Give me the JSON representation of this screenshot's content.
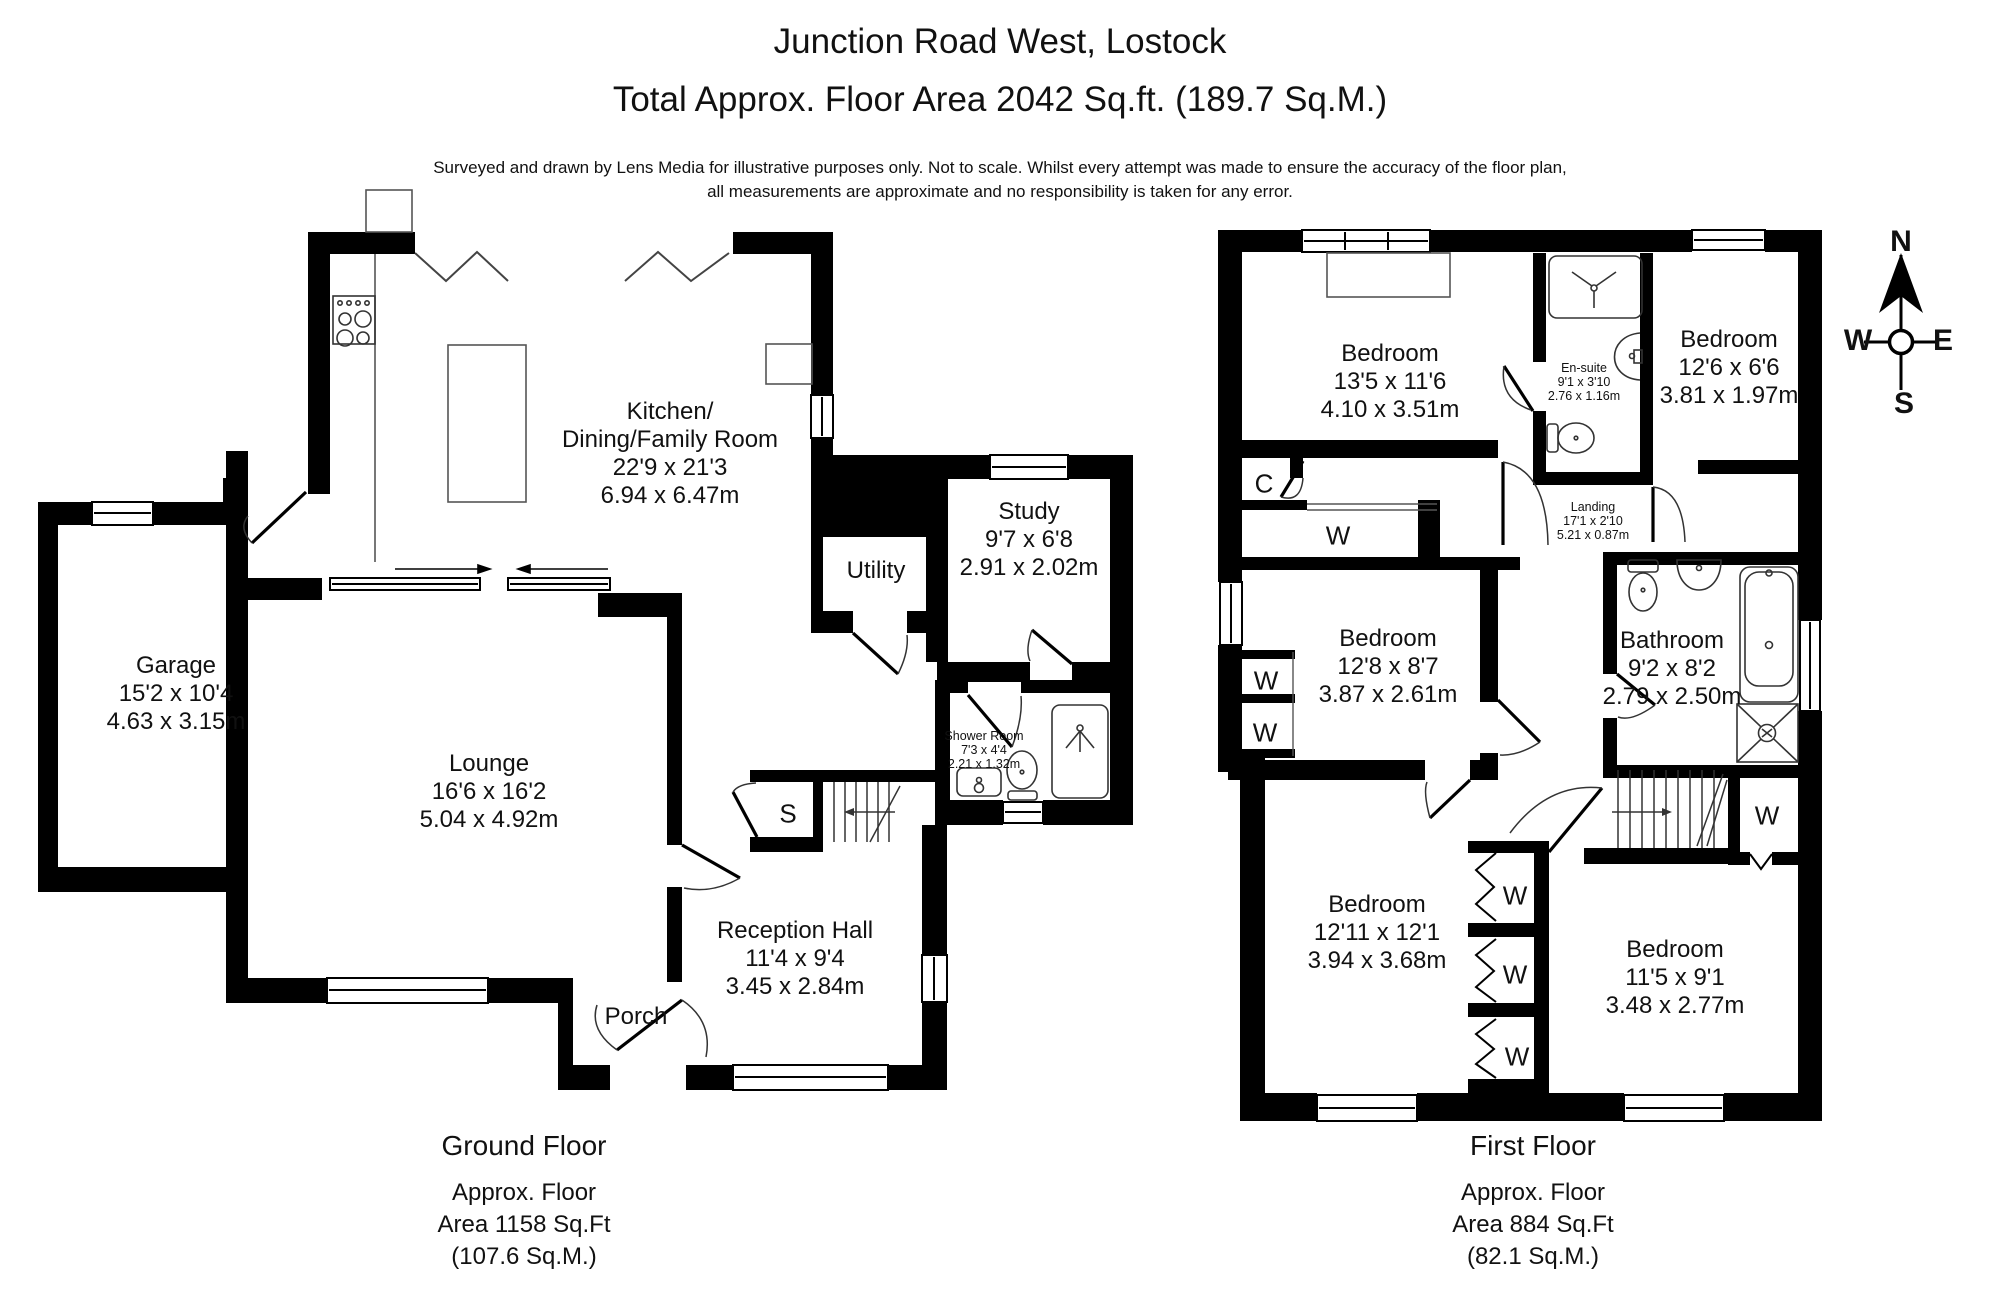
{
  "header": {
    "title": "Junction Road West, Lostock",
    "subtitle": "Total Approx. Floor Area 2042 Sq.ft. (189.7 Sq.M.)",
    "disclaimer_line1": "Surveyed and drawn by Lens Media for illustrative purposes only. Not to scale. Whilst every attempt was made to ensure the accuracy of the floor plan,",
    "disclaimer_line2": "all measurements are approximate and no responsibility is taken for any error."
  },
  "ground_floor": {
    "footer": {
      "title": "Ground Floor",
      "line1": "Approx. Floor",
      "line2": "Area 1158 Sq.Ft",
      "line3": "(107.6 Sq.M.)"
    },
    "rooms": {
      "kitchen": {
        "name1": "Kitchen/",
        "name2": "Dining/Family Room",
        "imperial": "22'9 x 21'3",
        "metric": "6.94 x 6.47m"
      },
      "garage": {
        "name": "Garage",
        "imperial": "15'2 x 10'4",
        "metric": "4.63 x 3.15m"
      },
      "lounge": {
        "name": "Lounge",
        "imperial": "16'6 x 16'2",
        "metric": "5.04 x 4.92m"
      },
      "study": {
        "name": "Study",
        "imperial": "9'7 x 6'8",
        "metric": "2.91 x 2.02m"
      },
      "utility": {
        "name": "Utility"
      },
      "shower_room": {
        "name": "Shower Room",
        "imperial": "7'3 x 4'4",
        "metric": "2.21 x 1.32m"
      },
      "reception_hall": {
        "name": "Reception Hall",
        "imperial": "11'4 x 9'4",
        "metric": "3.45 x 2.84m"
      },
      "porch": {
        "name": "Porch"
      }
    }
  },
  "first_floor": {
    "footer": {
      "title": "First Floor",
      "line1": "Approx. Floor",
      "line2": "Area 884 Sq.Ft",
      "line3": "(82.1 Sq.M.)"
    },
    "rooms": {
      "bedroom1": {
        "name": "Bedroom",
        "imperial": "13'5 x 11'6",
        "metric": "4.10 x 3.51m"
      },
      "ensuite": {
        "name": "En-suite",
        "imperial": "9'1 x 3'10",
        "metric": "2.76 x 1.16m"
      },
      "bedroom2": {
        "name": "Bedroom",
        "imperial": "12'6 x 6'6",
        "metric": "3.81 x 1.97m"
      },
      "landing": {
        "name": "Landing",
        "imperial": "17'1 x 2'10",
        "metric": "5.21 x 0.87m"
      },
      "bedroom3": {
        "name": "Bedroom",
        "imperial": "12'8 x 8'7",
        "metric": "3.87 x 2.61m"
      },
      "bathroom": {
        "name": "Bathroom",
        "imperial": "9'2 x 8'2",
        "metric": "2.79 x 2.50m"
      },
      "bedroom4": {
        "name": "Bedroom",
        "imperial": "12'11 x 12'1",
        "metric": "3.94 x 3.68m"
      },
      "bedroom5": {
        "name": "Bedroom",
        "imperial": "11'5 x 9'1",
        "metric": "3.48 x 2.77m"
      }
    }
  },
  "markers": {
    "wardrobe": "W",
    "cupboard": "C",
    "store": "S"
  },
  "compass": {
    "north": "N",
    "east": "E",
    "south": "S",
    "west": "W"
  },
  "colors": {
    "wall": "#000000",
    "background": "#ffffff"
  }
}
